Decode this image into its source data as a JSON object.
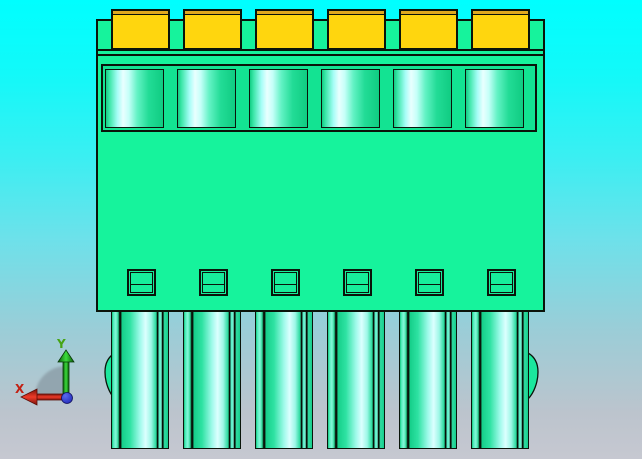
{
  "app": {
    "type": "cad-3d-viewport",
    "view": "front orthographic"
  },
  "model": {
    "description": "6-position green pluggable terminal block connector with yellow screw terminals, front view",
    "position_count": 6,
    "positions": [
      1,
      2,
      3,
      4,
      5,
      6
    ]
  },
  "axis_triad": {
    "x_label": "X",
    "y_label": "Y"
  },
  "colors": {
    "bg-top": "#00ffff",
    "bg-bottom": "#c6c8d1",
    "body-green": "#16f39c",
    "band-green": "#13e392",
    "slot-green": "#17ee9b",
    "cavity-highlight": "#e9ffff",
    "terminal-yellow": "#ffd60e",
    "terminal-shade": "#dfa81f",
    "outline": "#0a140a",
    "axis-x-red": "#d82718",
    "axis-y-green": "#2fb821",
    "axis-origin-blue": "#2531cc",
    "axis-shadow-gray": "#8b9ca6"
  }
}
